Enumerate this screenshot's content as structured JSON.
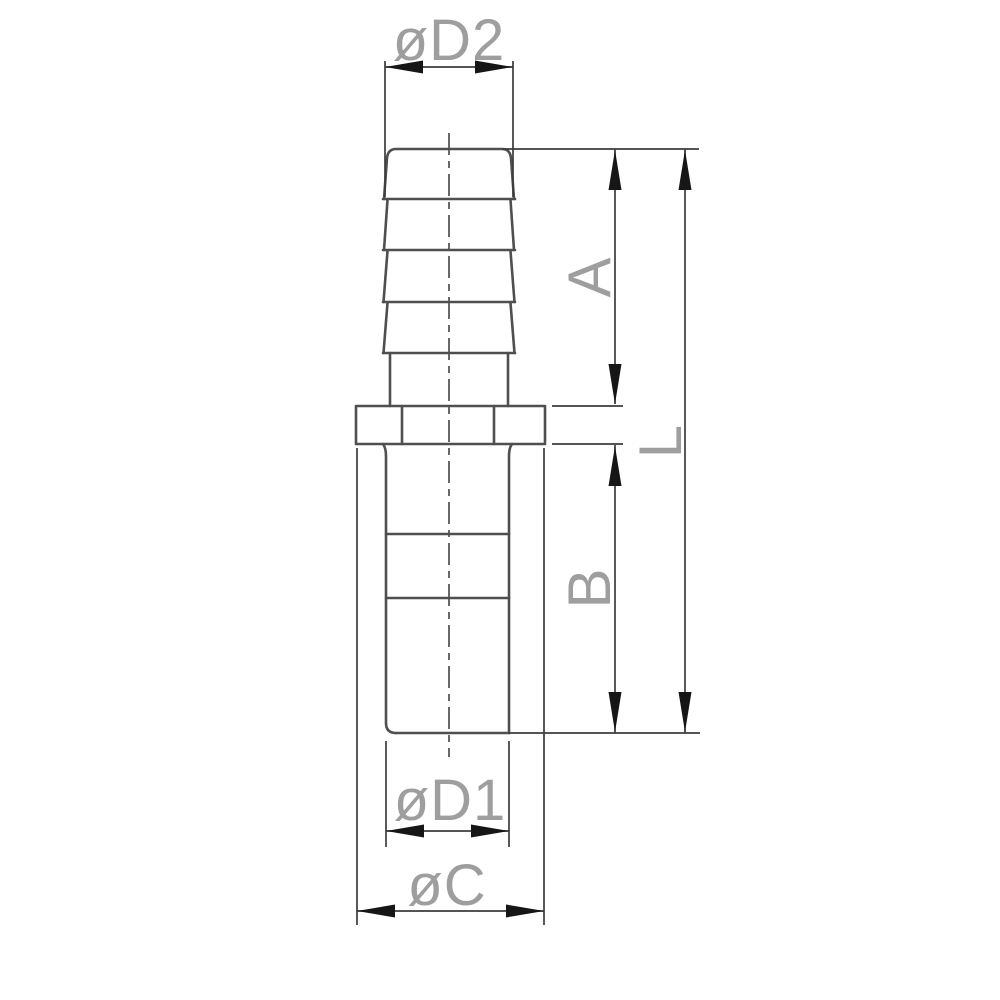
{
  "drawing": {
    "labels": {
      "d2": "øD2",
      "a": "A",
      "l": "L",
      "b": "B",
      "d1": "øD1",
      "c": "øC"
    },
    "colors": {
      "background": "#ffffff",
      "outline": "#4f4f4f",
      "dimension": "#3c3c3c",
      "arrow": "#161616",
      "label": "#9e9e9e"
    }
  }
}
